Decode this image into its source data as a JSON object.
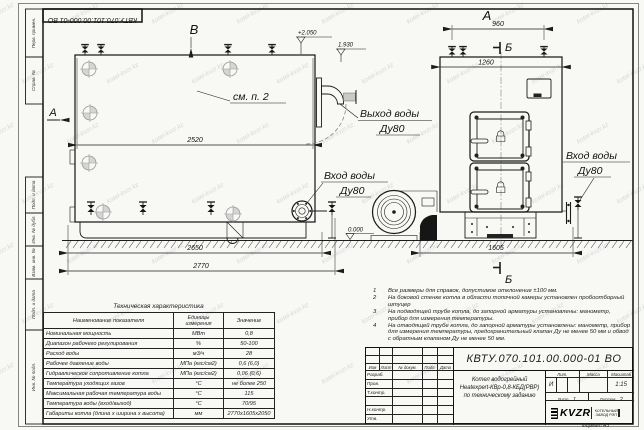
{
  "sheet": {
    "doc_number": "КВТУ.070.101.00.000-01 ВО",
    "format_label": "Формат А3",
    "watermark": "kotel-kvzr.kz"
  },
  "frame_labels": [
    "Перв. примен.",
    "Справ. №",
    "Подп. и дата",
    "Инв. № дубл.",
    "Взам. инв. №",
    "Подп. и дата",
    "Инв. № подл."
  ],
  "drawing": {
    "view_a": "А",
    "view_b": "Б",
    "view_v": "В",
    "see_item": "см. п. 2",
    "elev_top": "+2.050",
    "elev_pipe": "1.930",
    "elev_zero": "0.000",
    "dim_2520": "2520",
    "dim_2650": "2650",
    "dim_2770": "2770",
    "dim_960": "960",
    "dim_1260": "1260",
    "dim_1605": "1605",
    "water_out": "Выход воды",
    "water_out_dn": "Ду80",
    "water_in": "Вход воды",
    "water_in_dn": "Ду80"
  },
  "notes": [
    {
      "num": "1",
      "text": "Все размеры для справок, допустимое отклонение ±100 мм."
    },
    {
      "num": "2",
      "text": "На боковой стенке котла в области топочной камеры установлен пробоотборный штуцер"
    },
    {
      "num": "3",
      "text": "На подводящей трубе котла, до запорной арматуры установлены: манометр, прибор для измерения температуры."
    },
    {
      "num": "4",
      "text": "На отводящей трубе котла, до запорной арматуры установлены: манометр, прибор для измерения температуры, предохранительный клапан Ду не менее 50 мм и обвод с обратным клапаном Ду не менее 50 мм."
    }
  ],
  "tech_table": {
    "title": "Техническая характеристика",
    "columns": {
      "name": "Наименование показателя",
      "units": "Единицы измерения",
      "value": "Значение"
    },
    "rows": [
      {
        "name": "Номинальная мощность",
        "units": "МВт",
        "value": "0,8"
      },
      {
        "name": "Диапазон рабочего регулирования",
        "units": "%",
        "value": "50-100"
      },
      {
        "name": "Расход воды",
        "units": "м3/ч",
        "value": "28"
      },
      {
        "name": "Рабочее давление воды",
        "units": "МПа (кгс/см2)",
        "value": "0,6 (6,0)"
      },
      {
        "name": "Гидравлическое сопротивление котла",
        "units": "МПа (кгс/см2)",
        "value": "0,06 (0,6)"
      },
      {
        "name": "Температура уходящих газов",
        "units": "°С",
        "value": "не более 250"
      },
      {
        "name": "Максимальная рабочая температура воды",
        "units": "°С",
        "value": "115"
      },
      {
        "name": "Температура воды (вход/выход)",
        "units": "°С",
        "value": "70/95"
      },
      {
        "name": "Габариты котла (длина х ширина х высота)",
        "units": "мм",
        "value": "2770х1605х2050"
      }
    ]
  },
  "title_block": {
    "doc_number": "КВТУ.070.101.00.000-01 ВО",
    "cols": [
      "Изм",
      "Лист",
      "№ докум.",
      "Подп.",
      "Дата"
    ],
    "sign_rows": [
      "Разраб.",
      "Пров.",
      "Т.контр.",
      "",
      "Н.контр.",
      "Утв."
    ],
    "name1": "Котел водогрейный",
    "name2": "Heatexpert-КВр-0,8-КБД(РВР)",
    "name3": "по техническому заданию",
    "lit_label": "Лит.",
    "lit_value": "И",
    "mass_label": "Масса",
    "scale_label": "Масштаб",
    "scale_value": "1:15",
    "sheet_label": "Лист",
    "sheet_no": "1",
    "sheets_label": "Листов",
    "sheets_total": "2",
    "logo": "KVZR",
    "company1": "КОТЕЛЬНЫЙ",
    "company2": "ЗАВОД РЭП"
  }
}
